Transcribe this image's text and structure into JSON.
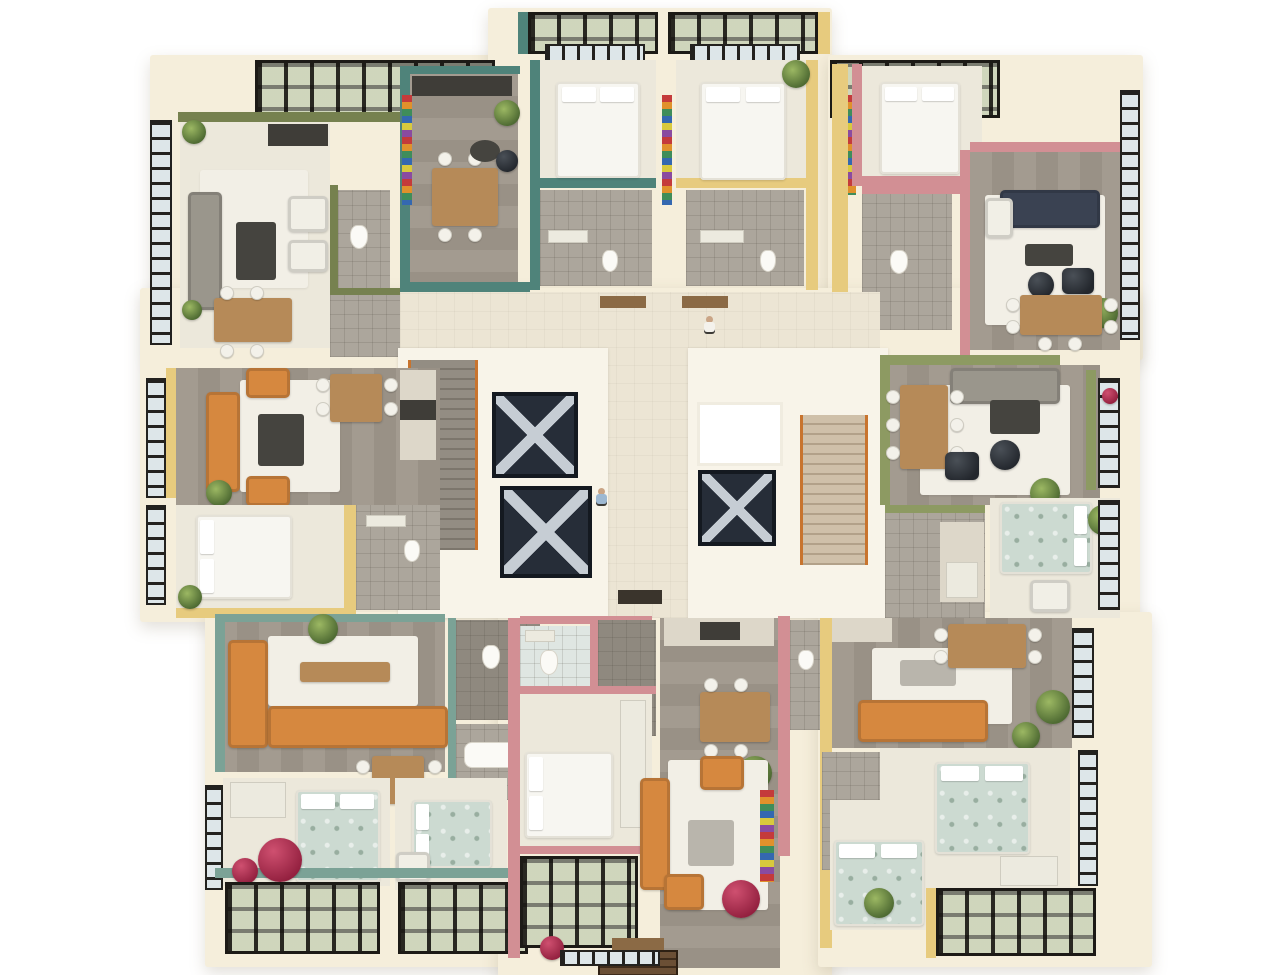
{
  "scene": {
    "description": "Top-down 3D architectural render of one residential floor: eight furnished colour-coded apartments arranged around a central hallway with two stairwells, three elevator shafts and a skylight",
    "type": "floor-plan-render",
    "background": "#ffffff"
  },
  "palette": {
    "plate_cream": "#f5eedb",
    "wall_white": "#f8f4e9",
    "olive_green": "#76814f",
    "teal": "#4f837a",
    "teal_light": "#7ba296",
    "rose_pink": "#d28f94",
    "yellow": "#e7cb7e",
    "sage_green": "#8d9a62",
    "wood_floor": "#a39b90",
    "pale_floor": "#ece8db",
    "tile_gray": "#aca69c",
    "window_frame": "#23221f",
    "window_glass": "#dde6e9",
    "orange_sofa": "#d6883f",
    "navy_sofa": "#3a4252",
    "gray_sofa": "#9a968c",
    "wood_table": "#b68a58",
    "magenta_pouf": "#b72f56",
    "plant_green": "#5f7f3f",
    "elevator_dark": "#262d38",
    "stair_accent_orange": "#c8742e",
    "glass_roof_green": "#aeb98a"
  },
  "building": {
    "core": {
      "stairwells": 2,
      "elevator_shafts": 3,
      "skylights": 1,
      "people_figures": 2,
      "entrance_steps": 1
    },
    "apartments": [
      {
        "position": "top-left",
        "accent_name": "olive-green",
        "accent_color": "#76814f",
        "rooms": [
          "living-room",
          "kitchen",
          "dining-area",
          "bathroom",
          "hallway"
        ]
      },
      {
        "position": "top-center-left",
        "accent_name": "teal",
        "accent_color": "#4f837a",
        "rooms": [
          "dining-room",
          "kitchen",
          "bedroom",
          "bathroom",
          "glass-roof-balcony"
        ]
      },
      {
        "position": "top-center-right",
        "accent_name": "yellow",
        "accent_color": "#e7cb7e",
        "rooms": [
          "bedroom",
          "bathroom",
          "glass-roof-balcony"
        ]
      },
      {
        "position": "top-right",
        "accent_name": "rose-pink",
        "accent_color": "#d28f94",
        "rooms": [
          "bedroom",
          "living-room",
          "dining-area",
          "bathroom"
        ]
      },
      {
        "position": "middle-left",
        "accent_name": "yellow",
        "accent_color": "#e7cb7e",
        "rooms": [
          "living-room",
          "dining-area",
          "kitchen",
          "bedroom",
          "bathroom"
        ]
      },
      {
        "position": "middle-right",
        "accent_name": "sage-green",
        "accent_color": "#8d9a62",
        "rooms": [
          "living-room",
          "dining-area",
          "kitchen",
          "bedroom"
        ]
      },
      {
        "position": "bottom-left",
        "accent_name": "teal",
        "accent_color": "#7ba296",
        "rooms": [
          "living-room",
          "dining-area",
          "bedroom",
          "bedroom-2",
          "bathroom",
          "bathroom-2",
          "glass-roof-balcony"
        ]
      },
      {
        "position": "bottom-center",
        "accent_name": "rose-pink",
        "accent_color": "#d28f94",
        "rooms": [
          "bedroom",
          "living-room",
          "kitchen",
          "dining-area",
          "bathroom",
          "shower-room",
          "glass-roof-balcony"
        ]
      },
      {
        "position": "bottom-right",
        "accent_name": "yellow",
        "accent_color": "#e7cb7e",
        "rooms": [
          "living-room",
          "dining-area",
          "bedroom",
          "bedroom-2",
          "bathroom",
          "glass-roof-balcony"
        ]
      }
    ]
  }
}
